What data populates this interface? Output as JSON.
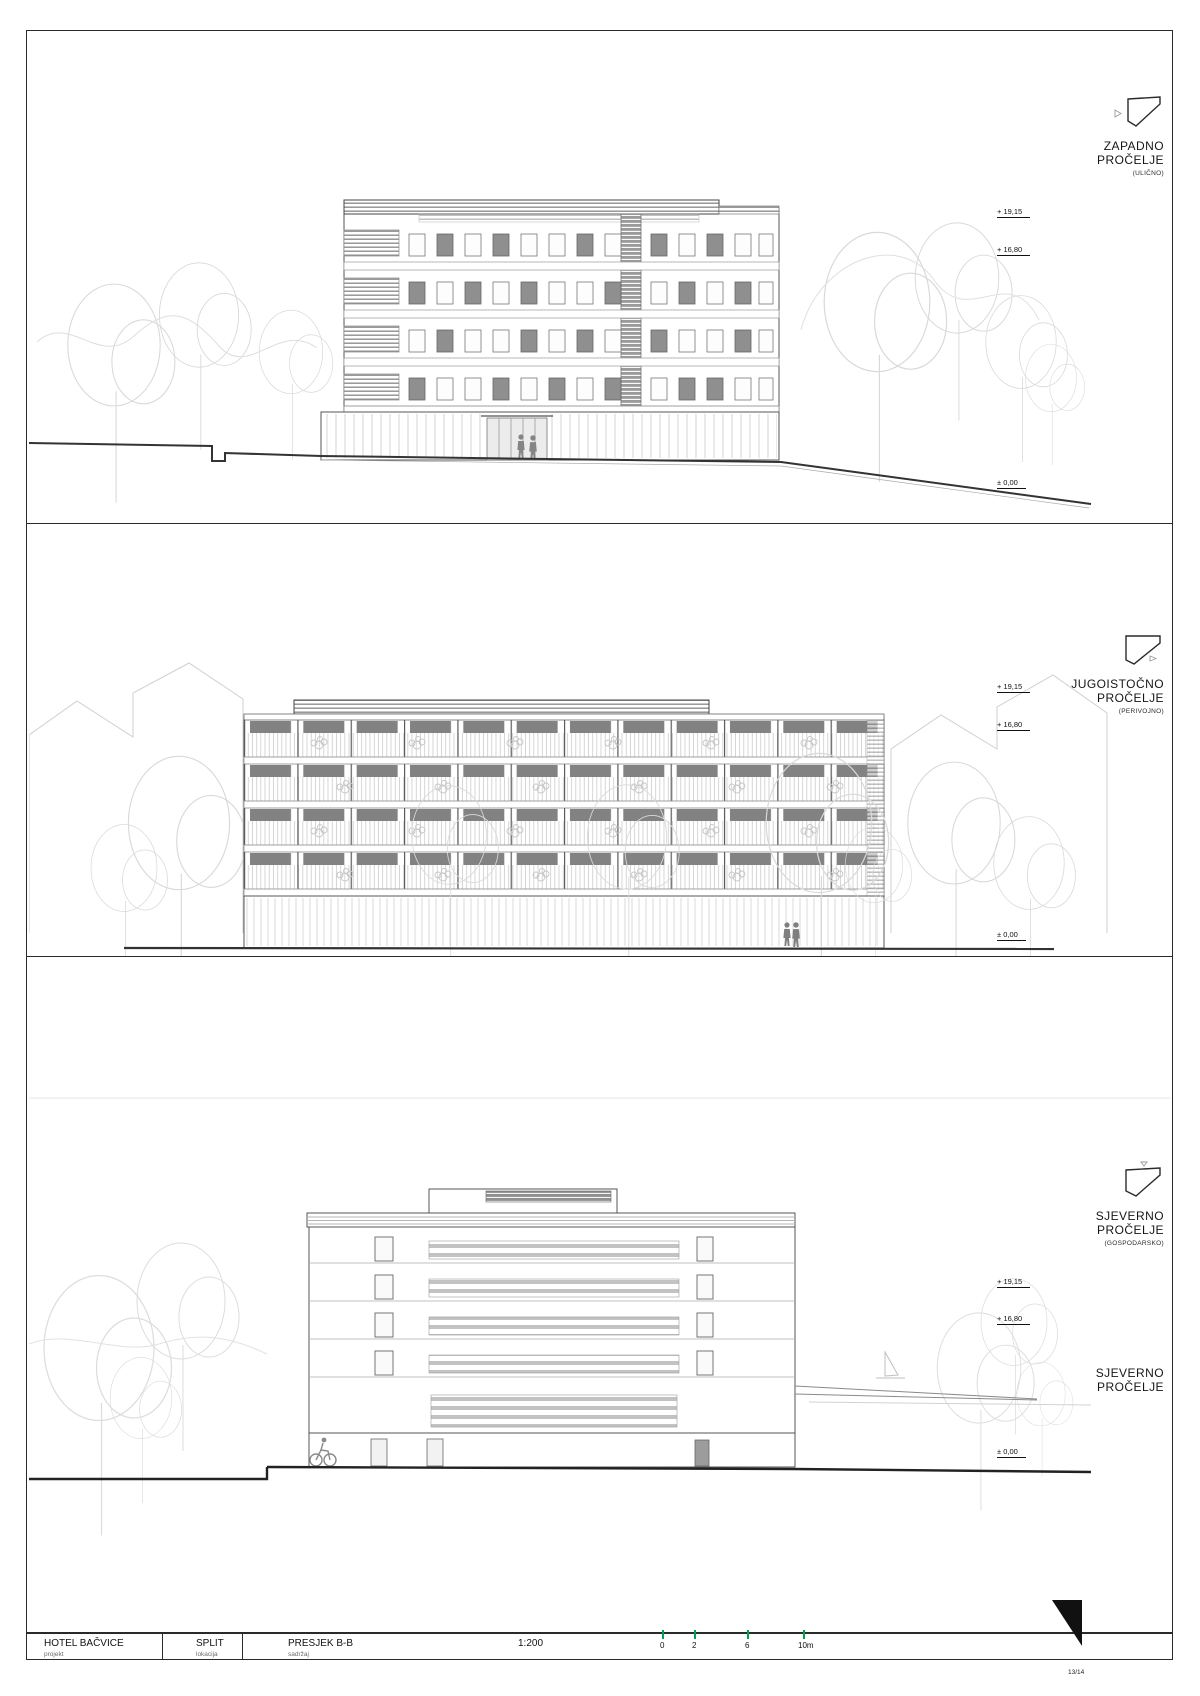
{
  "page": {
    "number": "13/14"
  },
  "panels": [
    {
      "label1": "ZAPADNO",
      "label2": "PROČELJE",
      "sublabel": "(ULIČNO)",
      "markers": [
        "+ 19,15",
        "+ 16,80",
        "± 0,00"
      ]
    },
    {
      "label1": "JUGOISTOČNO",
      "label2": "PROČELJE",
      "sublabel": "(PERIVOJNO)",
      "markers": [
        "+ 19,15",
        "+ 16,80",
        "± 0,00"
      ]
    },
    {
      "label1": "SJEVERNO",
      "label2": "PROČELJE",
      "sublabel": "(GOSPODARSKO)",
      "label1b": "SJEVERNO",
      "label2b": "PROČELJE",
      "markers": [
        "+ 19,15",
        "+ 16,80",
        "± 0,00"
      ]
    }
  ],
  "titleblock": {
    "project_value": "HOTEL BAČVICE",
    "project_caption": "projekt",
    "location_value": "SPLIT",
    "location_caption": "lokacija",
    "content_value": "PRESJEK B-B",
    "content_caption": "sadržaj",
    "scale_value": "1:200",
    "scalebar_labels": [
      "0",
      "2",
      "6",
      "10m"
    ]
  }
}
